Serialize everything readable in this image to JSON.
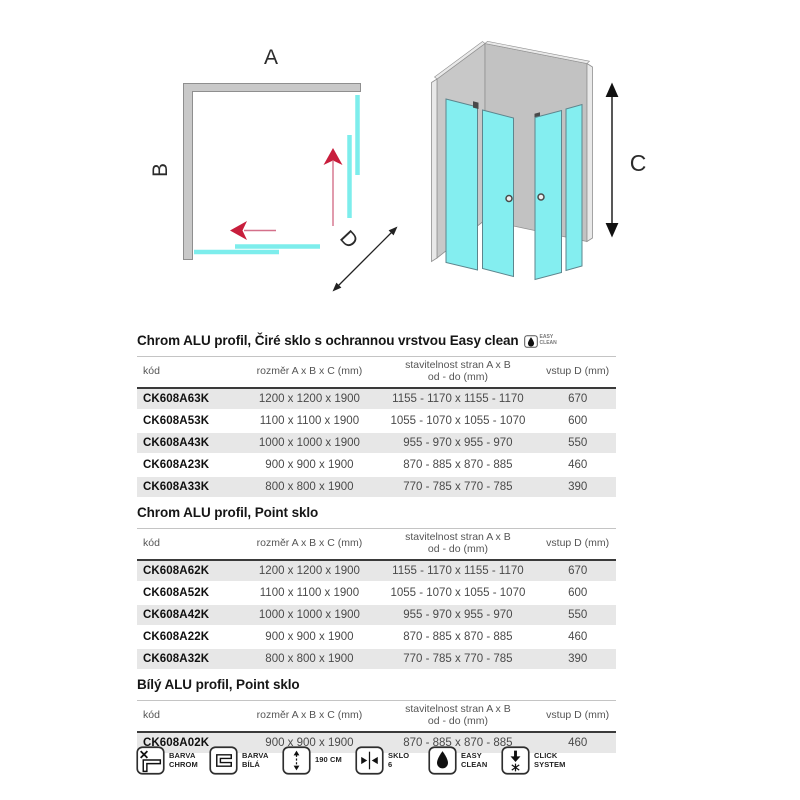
{
  "diagram2d": {
    "label_a": "A",
    "label_b": "B",
    "label_d": "D"
  },
  "diagram3d": {
    "label_c": "C"
  },
  "sections": [
    {
      "title": "Chrom ALU profil, Čiré sklo s ochrannou vrstvou Easy clean",
      "badge": {
        "line1": "EASY",
        "line2": "CLEAN"
      },
      "columns": [
        {
          "l1": "kód"
        },
        {
          "l1": "rozměr A x B x C (mm)"
        },
        {
          "l1": "stavitelnost stran A x B",
          "l2": "od - do (mm)"
        },
        {
          "l1": "vstup D (mm)"
        }
      ],
      "rows": [
        [
          "CK608A63K",
          "1200 x 1200 x 1900",
          "1155 - 1170 x 1155 - 1170",
          "670"
        ],
        [
          "CK608A53K",
          "1100 x 1100 x 1900",
          "1055 - 1070 x 1055 - 1070",
          "600"
        ],
        [
          "CK608A43K",
          "1000 x 1000 x 1900",
          "955 - 970 x 955 - 970",
          "550"
        ],
        [
          "CK608A23K",
          "900 x 900 x 1900",
          "870 - 885 x 870 - 885",
          "460"
        ],
        [
          "CK608A33K",
          "800 x 800 x 1900",
          "770 - 785 x 770 - 785",
          "390"
        ]
      ]
    },
    {
      "title": "Chrom ALU profil, Point sklo",
      "columns": [
        {
          "l1": "kód"
        },
        {
          "l1": "rozměr A x B x C (mm)"
        },
        {
          "l1": "stavitelnost stran A x B",
          "l2": "od - do (mm)"
        },
        {
          "l1": "vstup D (mm)"
        }
      ],
      "rows": [
        [
          "CK608A62K",
          "1200 x 1200 x 1900",
          "1155 - 1170 x 1155 - 1170",
          "670"
        ],
        [
          "CK608A52K",
          "1100 x 1100 x 1900",
          "1055 - 1070 x 1055 - 1070",
          "600"
        ],
        [
          "CK608A42K",
          "1000 x 1000 x 1900",
          "955 - 970 x 955 - 970",
          "550"
        ],
        [
          "CK608A22K",
          "900 x 900 x 1900",
          "870 - 885 x 870 - 885",
          "460"
        ],
        [
          "CK608A32K",
          "800 x 800 x 1900",
          "770 - 785 x 770 - 785",
          "390"
        ]
      ]
    },
    {
      "title": "Bílý ALU profil, Point sklo",
      "columns": [
        {
          "l1": "kód"
        },
        {
          "l1": "rozměr A x B x C (mm)"
        },
        {
          "l1": "stavitelnost stran A x B",
          "l2": "od - do (mm)"
        },
        {
          "l1": "vstup D (mm)"
        }
      ],
      "rows": [
        [
          "CK608A02K",
          "900 x 900 x 1900",
          "870 - 885 x 870 - 885",
          "460"
        ]
      ]
    }
  ],
  "footer_icons": [
    {
      "name": "barva-chrom",
      "line1": "BARVA",
      "line2": "CHROM"
    },
    {
      "name": "barva-bila",
      "line1": "BARVA",
      "line2": "BÍLÁ"
    },
    {
      "name": "height-190",
      "line1": "190 CM",
      "line2": ""
    },
    {
      "name": "sklo-6",
      "line1": "SKLO",
      "line2": "6"
    },
    {
      "name": "easy-clean",
      "line1": "EASY",
      "line2": "CLEAN"
    },
    {
      "name": "click-system",
      "line1": "CLICK",
      "line2": "SYSTEM"
    }
  ],
  "colors": {
    "glass_2d": "#7dedec",
    "glass_3d": "#84eef0",
    "glass_outline": "#5d858d",
    "wall_gray": "#c8c8c8",
    "arrow_pink": "#c81e3c",
    "arrow_pink_shaft": "#d4708a",
    "row_shade": "#e7e7e7",
    "header_rule": "#3a3a3a"
  }
}
